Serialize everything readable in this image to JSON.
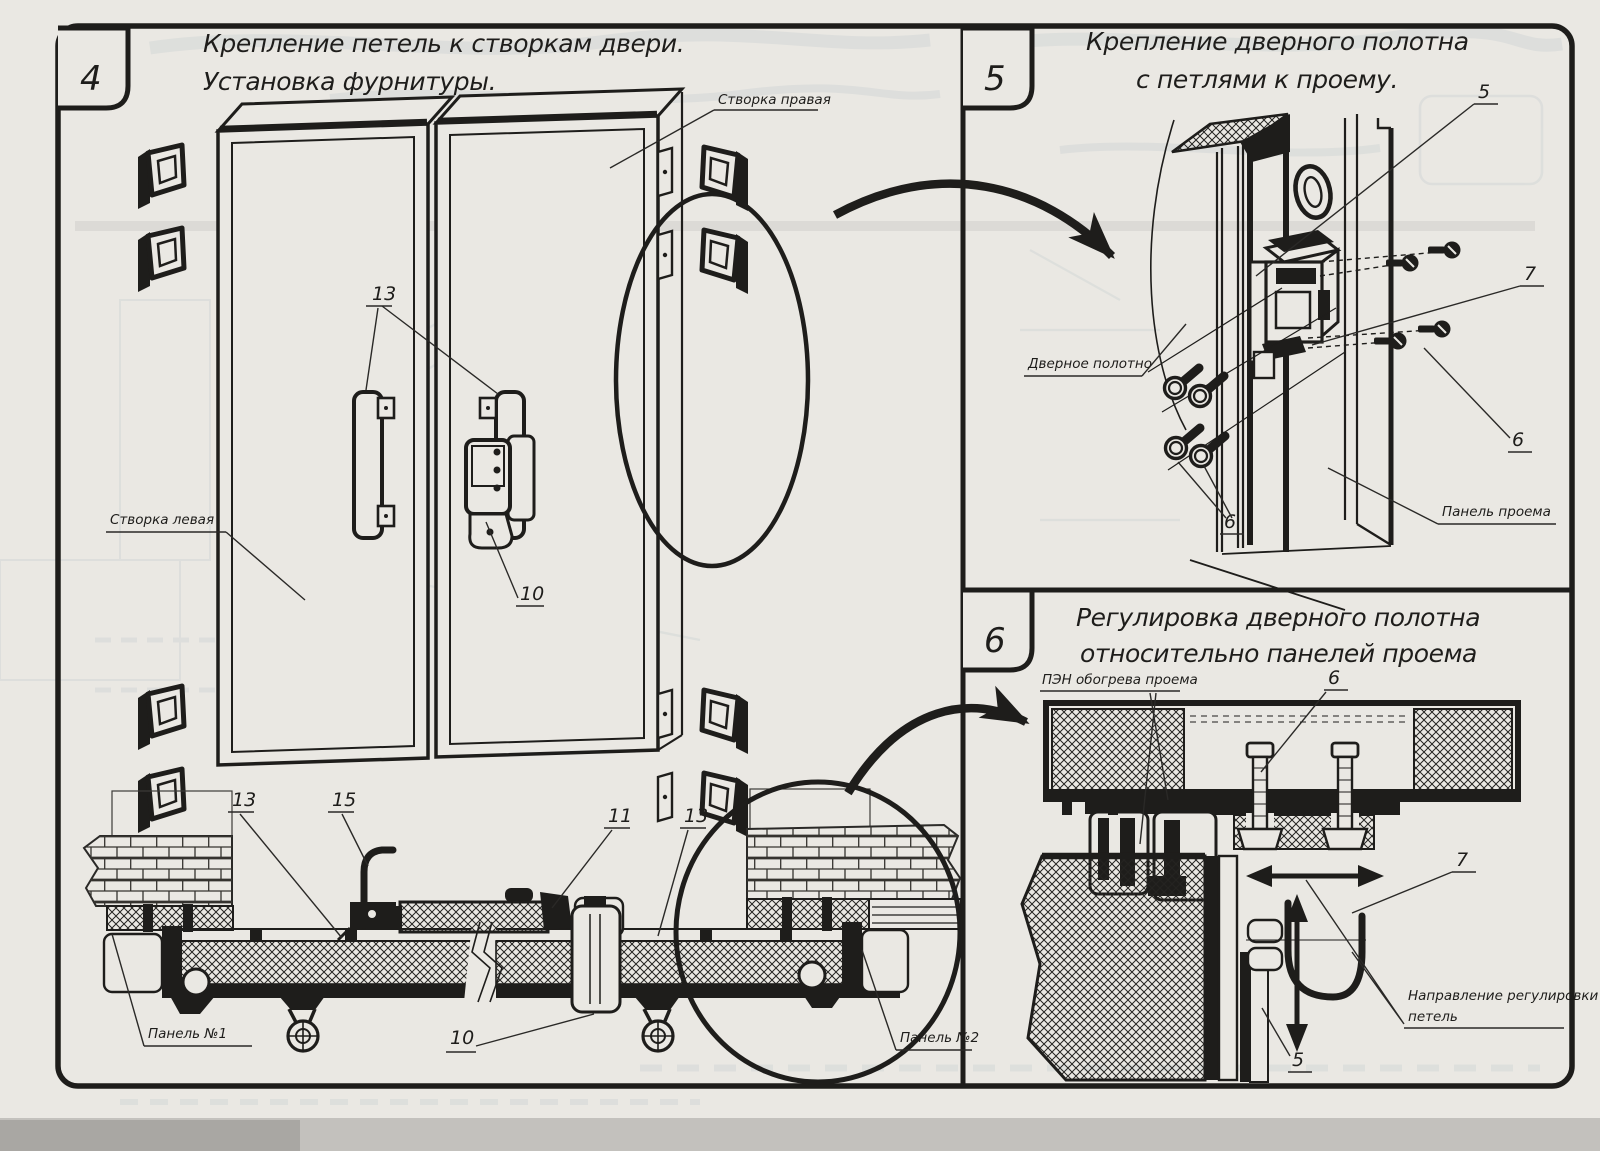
{
  "colors": {
    "paper": "#eae8e3",
    "ink": "#1e1d1b",
    "ghost": "#8da0b0"
  },
  "panel4": {
    "number": "4",
    "title1": "Крепление петель к створкам двери.",
    "title2": "Установка фурнитуры.",
    "label_right_leaf": "Створка правая",
    "label_left_leaf": "Створка левая",
    "label_panel1": "Панель №1",
    "label_panel2": "Панель №2",
    "callout_13": "13",
    "callout_15": "15",
    "callout_11": "11",
    "callout_10": "10"
  },
  "panel5": {
    "number": "5",
    "title1": "Крепление дверного полотна",
    "title2": "с петлями к проему.",
    "label_door_leaf": "Дверное полотно",
    "label_opening_panel": "Панель проема",
    "callout_5": "5",
    "callout_6": "6",
    "callout_7": "7"
  },
  "panel6": {
    "number": "6",
    "title1": "Регулировка дверного полотна",
    "title2": "относительно панелей проема",
    "label_heater": "ПЭН обогрева проема",
    "label_direction1": "Направление регулировки",
    "label_direction2": "петель",
    "callout_5": "5",
    "callout_6": "6",
    "callout_7": "7"
  }
}
